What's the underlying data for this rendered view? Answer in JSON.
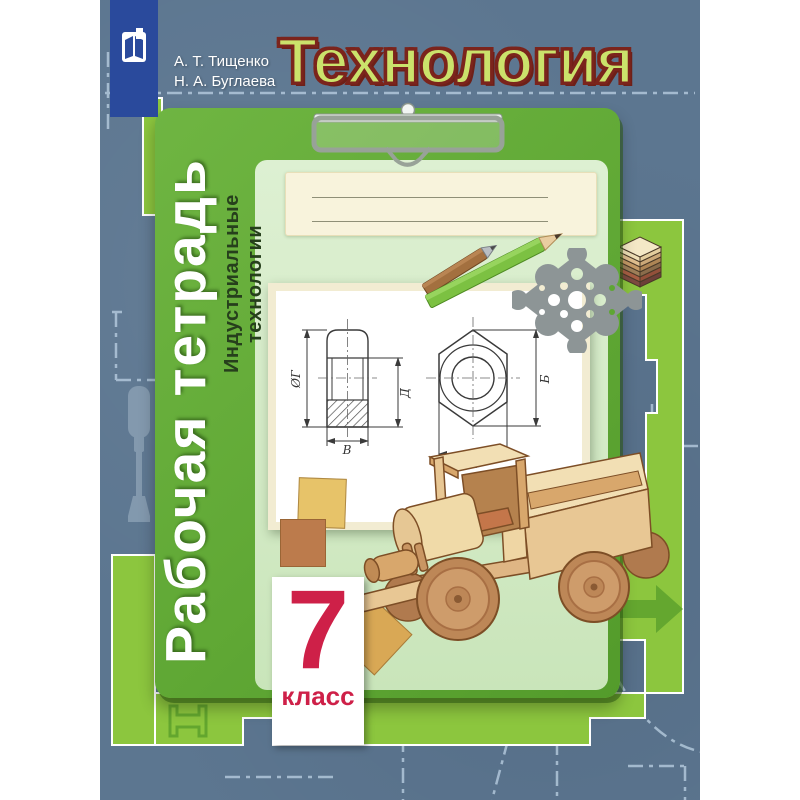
{
  "cover": {
    "author1": "А. Т. Тищенко",
    "author2": "Н. А. Буглаева",
    "title": "Технология",
    "series_vertical": "Рабочая тетрадь",
    "subtitle_vertical": "Индустриальные технологии",
    "grade_number": "7",
    "grade_word": "класс",
    "drawing_labels": {
      "diameter": "ØГ",
      "height": "Д",
      "width": "В",
      "across_corners": "Б",
      "across_flats": "А"
    },
    "colors": {
      "background": "#5C7690",
      "lime": "#8CC63E",
      "card_green": "#60A835",
      "panel_green": "#D7ECCA",
      "cream": "#F8F3DC",
      "title_fill": "#CBE26B",
      "title_outline": "#7B241C",
      "accent_red": "#CE2048",
      "publisher_blue": "#2A4A9C"
    },
    "icons": [
      "publisher-logo-icon",
      "clipboard-clip-icon",
      "pencil-icon",
      "fretwork-ornament-icon",
      "plywood-stack-icon",
      "wooden-truck-illustration",
      "chisel-icon",
      "arrow-right-icon",
      "i-beam-icon",
      "hex-nut-technical-drawing"
    ]
  }
}
